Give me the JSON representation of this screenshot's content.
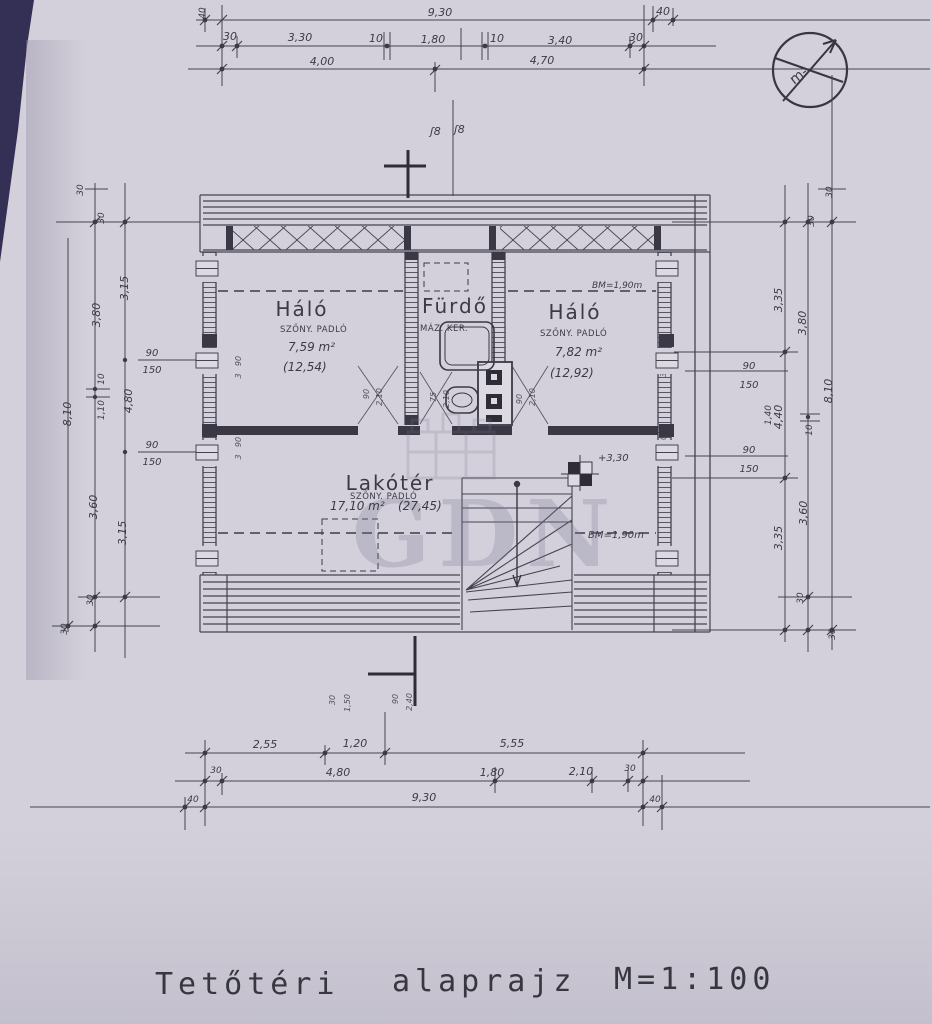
{
  "title": {
    "part1": "Tetőtéri",
    "part2": "alaprajz",
    "scale": "M=1:100"
  },
  "north": {
    "label": "m-"
  },
  "watermark": {
    "text": "GDN"
  },
  "rooms": {
    "bedroom_left": {
      "name": "Háló",
      "floor": "SZŐNY. PADLÓ",
      "area": "7,59 m²",
      "gross": "(12,54)"
    },
    "bathroom": {
      "name": "Fürdő",
      "floor": "MÁZ. KER."
    },
    "bedroom_right": {
      "name": "Háló",
      "floor": "SZŐNY. PADLÓ",
      "area": "7,82 m²",
      "gross": "(12,92)"
    },
    "living": {
      "name": "Lakótér",
      "floor": "SZŐNY. PADLÓ",
      "area": "17,10 m²",
      "gross": "(27,45)"
    }
  },
  "levels": {
    "attic_level": "+3,30",
    "knee_upper": "BM=1,90m",
    "knee_lower": "BM=1,90m",
    "flue_left": "ʃ8",
    "flue_right": "ʃ8"
  },
  "dims_top": {
    "left_overhang": "40",
    "total": "9,30",
    "right_overhang": "40",
    "row2": [
      "30",
      "3,30",
      "10",
      "1,80",
      "10",
      "3,40",
      "30"
    ],
    "row3": [
      "4,00",
      "4,70"
    ]
  },
  "dims_bottom": {
    "row1": [
      "2,55",
      "1,20",
      "5,55"
    ],
    "row2": [
      "30",
      "4,80",
      "1,80",
      "2,10",
      "30"
    ],
    "row3": [
      "40",
      "9,30",
      "40"
    ],
    "door_marks": [
      "30",
      "1,50",
      "90",
      "2,40"
    ]
  },
  "dims_left": {
    "total": "8,10",
    "c": [
      "30",
      "30",
      "3,80",
      "3,15",
      "10",
      "1,10",
      "4,80",
      "3,60",
      "3,15",
      "30",
      "30"
    ],
    "win1": [
      "90",
      "150"
    ],
    "win2": [
      "90",
      "150"
    ],
    "wall_marks": [
      "90",
      "3",
      "90",
      "3"
    ]
  },
  "dims_right": {
    "total": "8,10",
    "c": [
      "30",
      "30",
      "3,35",
      "3,80",
      "4,40",
      "10",
      "3,60",
      "3,35",
      "30",
      "30"
    ],
    "win1": [
      "90",
      "150"
    ],
    "win2": [
      "90",
      "150"
    ],
    "sill": "1,40",
    "wall_marks": [
      "90",
      "3",
      "90",
      "3"
    ]
  },
  "dims_doors": {
    "d1": [
      "90",
      "2,10"
    ],
    "d2": [
      "75",
      "2,10"
    ],
    "d3": [
      "90",
      "2,10"
    ]
  }
}
